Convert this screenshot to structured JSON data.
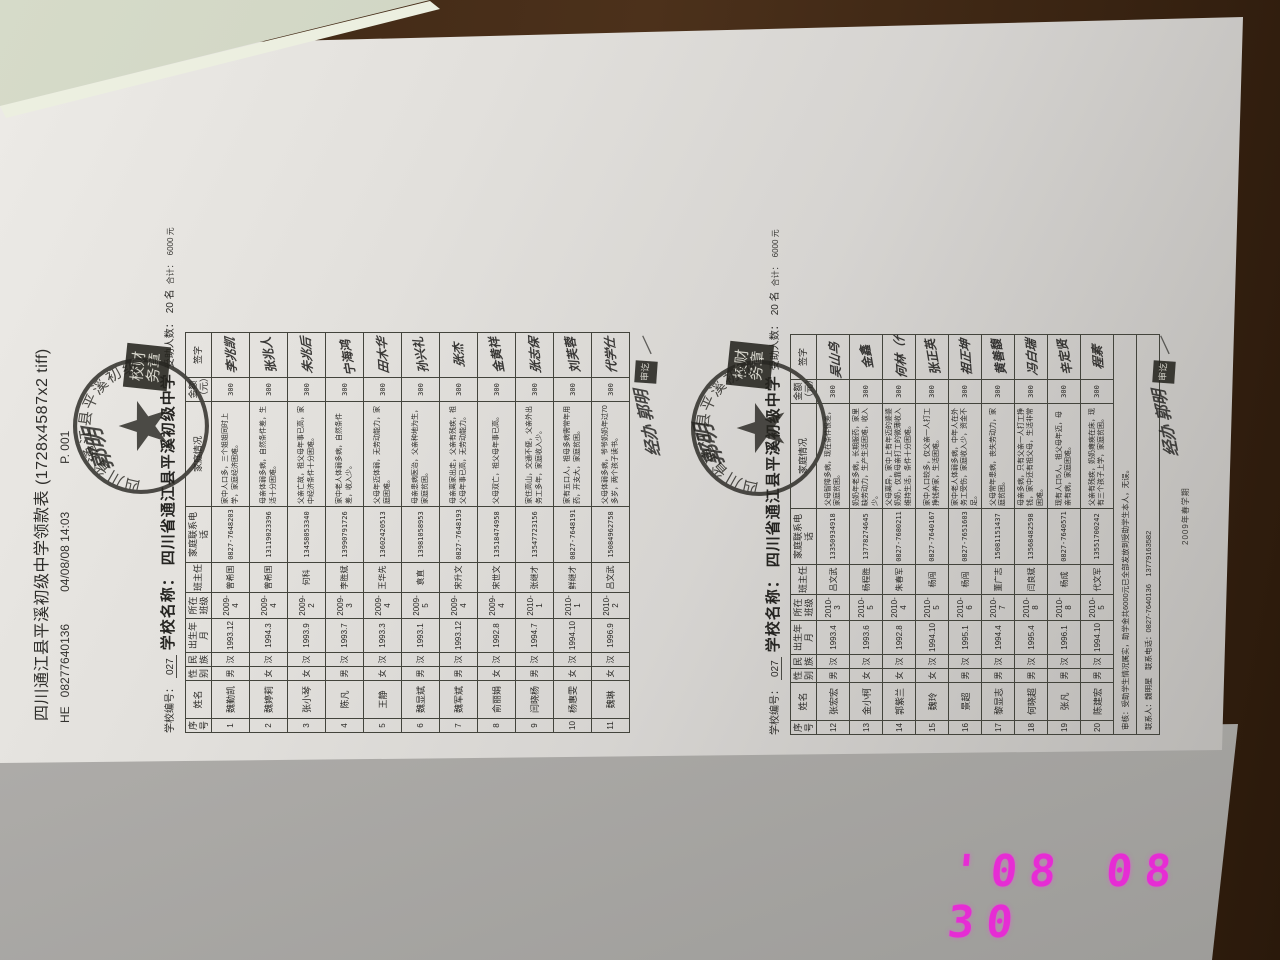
{
  "photo": {
    "timestamp_text": "'08 08 30",
    "timestamp_color": "#e62cd4"
  },
  "fax_header": {
    "title": "四川通江县平溪初级中学领款表 (1728x4587x2 tiff)",
    "mark": "HE",
    "fax_number": "08277640136",
    "datetime": "04/08/08 14:03",
    "page_no": "P. 001"
  },
  "stamps": {
    "round_text": "四川省通江县平溪初级中学",
    "rect_seal_text": "校财务章",
    "header_signature": "郭明",
    "note_signature": "经办 郭明",
    "small_seal_text": "审讫",
    "note_stroke": "—"
  },
  "columns": [
    "序号",
    "姓名",
    "性别",
    "民族",
    "出生年月",
    "所在班级",
    "班主任",
    "家庭联系电话",
    "家庭情况",
    "金额（元）",
    "签字"
  ],
  "tables": [
    {
      "school_no_label": "学校编号：",
      "school_no": "027",
      "school_name_label": "学校名称：",
      "school_name": "四川省通江县平溪初级中学",
      "recipients_label": "受助人数：",
      "recipients": "20 名",
      "total_label": "合计：",
      "total": "6000 元",
      "rows": [
        {
          "no": "1",
          "name": "魏勤凯",
          "sex": "男",
          "ethnic": "汉",
          "birth": "1993.12",
          "klass": "2009-4",
          "teacher": "曾希国",
          "phone": "0827-7648203",
          "situation": "家中人口多，三个姐姐同时上学，家庭经济困难。",
          "amount": "300",
          "signature": "李兆凯"
        },
        {
          "no": "2",
          "name": "魏婷莉",
          "sex": "女",
          "ethnic": "汉",
          "birth": "1994.3",
          "klass": "2009-4",
          "teacher": "曾希国",
          "phone": "13119023396",
          "situation": "母亲体弱多病，自然条件差，生活十分困难。",
          "amount": "300",
          "signature": "张兆人"
        },
        {
          "no": "3",
          "name": "张小琴",
          "sex": "女",
          "ethnic": "汉",
          "birth": "1993.9",
          "klass": "2009-2",
          "teacher": "何科",
          "phone": "13458053340",
          "situation": "父亲亡故，祖父母年事已高，家中经济条件十分困难。",
          "amount": "300",
          "signature": "朱兆后"
        },
        {
          "no": "4",
          "name": "陈凡",
          "sex": "男",
          "ethnic": "汉",
          "birth": "1993.7",
          "klass": "2009-3",
          "teacher": "李胜斌",
          "phone": "13990791726",
          "situation": "家中老人体弱多病，自然条件差，收入少。",
          "amount": "300",
          "signature": "宁海鸿（代）"
        },
        {
          "no": "5",
          "name": "王静",
          "sex": "女",
          "ethnic": "汉",
          "birth": "1993.3",
          "klass": "2009-4",
          "teacher": "王华先",
          "phone": "13602420513",
          "situation": "父母年迈体弱，无劳动能力，家庭困难。",
          "amount": "300",
          "signature": "田木华"
        },
        {
          "no": "6",
          "name": "魏显斌",
          "sex": "男",
          "ethnic": "汉",
          "birth": "1993.1",
          "klass": "2009-5",
          "teacher": "袁直",
          "phone": "13981058953",
          "situation": "母亲患病医治，父亲种地为生，家庭贫困。",
          "amount": "300",
          "signature": "孙兴礼"
        },
        {
          "no": "7",
          "name": "魏军斌",
          "sex": "男",
          "ethnic": "汉",
          "birth": "1993.12",
          "klass": "2009-4",
          "teacher": "宋升文",
          "phone": "0827-7648193",
          "situation": "母亲离家出走，父亲有残疾，祖父母年事已高，无劳动能力。",
          "amount": "300",
          "signature": "张杰"
        },
        {
          "no": "8",
          "name": "俞丽娟",
          "sex": "女",
          "ethnic": "汉",
          "birth": "1992.8",
          "klass": "2009-4",
          "teacher": "宋世文",
          "phone": "13518474958",
          "situation": "父母双亡，祖父母年事已高。",
          "amount": "300",
          "signature": "金黄祥"
        },
        {
          "no": "9",
          "name": "闫晓杨",
          "sex": "男",
          "ethnic": "汉",
          "birth": "1994.7",
          "klass": "2010-1",
          "teacher": "张继才",
          "phone": "13547723156",
          "situation": "家住高山，交通不便，父亲外出务工多年，家庭收入少。",
          "amount": "300",
          "signature": "张志保"
        },
        {
          "no": "10",
          "name": "杨惠雯",
          "sex": "女",
          "ethnic": "汉",
          "birth": "1994.10",
          "klass": "2010-1",
          "teacher": "鲜继才",
          "phone": "0827-7648191",
          "situation": "家有五口人，祖母多病需常年用药，开支大，家庭贫困。",
          "amount": "300",
          "signature": "刘芙蓉"
        },
        {
          "no": "11",
          "name": "魏琳",
          "sex": "女",
          "ethnic": "汉",
          "birth": "1996.9",
          "klass": "2010-2",
          "teacher": "吕文武",
          "phone": "15084962758",
          "situation": "父母体弱多病，爷爷奶奶年过70多岁，两个孩子读书。",
          "amount": "300",
          "signature": "代学仕"
        }
      ]
    },
    {
      "school_no_label": "学校编号：",
      "school_no": "027",
      "school_name_label": "学校名称：",
      "school_name": "四川省通江县平溪初级中学",
      "recipients_label": "受助人数：",
      "recipients": "20 名",
      "total_label": "合计：",
      "total": "6000 元",
      "rows": [
        {
          "no": "12",
          "name": "张宏宏",
          "sex": "男",
          "ethnic": "汉",
          "birth": "1993.4",
          "klass": "2010-3",
          "teacher": "吕文武",
          "phone": "13350934918",
          "situation": "父母智障多病，现在条件很差，家庭贫困。",
          "amount": "300",
          "signature": "吴山鸟（代）"
        },
        {
          "no": "13",
          "name": "金小柯",
          "sex": "女",
          "ethnic": "汉",
          "birth": "1993.6",
          "klass": "2010-5",
          "teacher": "杨程胜",
          "phone": "13778274645",
          "situation": "奶奶年老多病，长期服药，家里缺劳动力，生产生活困难，收入少。",
          "amount": "300",
          "signature": "金鑫"
        },
        {
          "no": "14",
          "name": "郭紫兰",
          "sex": "女",
          "ethnic": "汉",
          "birth": "1992.8",
          "klass": "2010-4",
          "teacher": "朱春军",
          "phone": "0827-7680211",
          "situation": "父母离异，家中上有年迈的婆婆奶奶，仅靠母亲打工的微薄收入维持生活，条件十分困难。",
          "amount": "300",
          "signature": "何林（代）"
        },
        {
          "no": "15",
          "name": "魏玲",
          "sex": "女",
          "ethnic": "汉",
          "birth": "1994.10",
          "klass": "2010-5",
          "teacher": "杨闯",
          "phone": "0827-7640167",
          "situation": "家中人口较多，仅父亲一人打工挣钱养家，生活困难。",
          "amount": "300",
          "signature": "张正英"
        },
        {
          "no": "16",
          "name": "景超",
          "sex": "男",
          "ethnic": "汉",
          "birth": "1995.1",
          "klass": "2010-6",
          "teacher": "杨闯",
          "phone": "0827-7651603",
          "situation": "家中老人体弱多病，中年人在外务工受伤，家庭收入少，资金不足。",
          "amount": "300",
          "signature": "祖正坤"
        },
        {
          "no": "17",
          "name": "黎显志",
          "sex": "男",
          "ethnic": "汉",
          "birth": "1994.4",
          "klass": "2010-7",
          "teacher": "董广志",
          "phone": "15081151437",
          "situation": "父母常年患病，丧失劳动力，家庭贫困。",
          "amount": "300",
          "signature": "黄善馥"
        },
        {
          "no": "18",
          "name": "何晓超",
          "sex": "男",
          "ethnic": "汉",
          "birth": "1995.4",
          "klass": "2010-8",
          "teacher": "闫良斌",
          "phone": "13568482598",
          "situation": "母亲多病，只有父亲一人打工挣钱，家中还有祖父母，生活非常困难。",
          "amount": "300",
          "signature": "冯白瑞"
        },
        {
          "no": "19",
          "name": "张凡",
          "sex": "男",
          "ethnic": "汉",
          "birth": "1996.1",
          "klass": "2010-8",
          "teacher": "杨成",
          "phone": "0827-7640571",
          "situation": "现有人口5人，祖父母年迈，母亲有病，家庭困难。",
          "amount": "300",
          "signature": "辛定贤"
        },
        {
          "no": "20",
          "name": "陈建宏",
          "sex": "男",
          "ethnic": "汉",
          "birth": "1994.10",
          "klass": "2010-5",
          "teacher": "代文军",
          "phone": "13551700242",
          "situation": "父亲有残疾，奶奶瘫痪在床，现有三个孩子上学，家庭贫困。",
          "amount": "300",
          "signature": "程素"
        }
      ],
      "footer_note": "审核：受助学生情况属实，助学金共6000元已全部发放到受助学生本人，无误。",
      "footer_contact": "联系人：魏明星　联系电话：0827-7640136　13779163582",
      "term_note": "2009年春学期"
    }
  ]
}
